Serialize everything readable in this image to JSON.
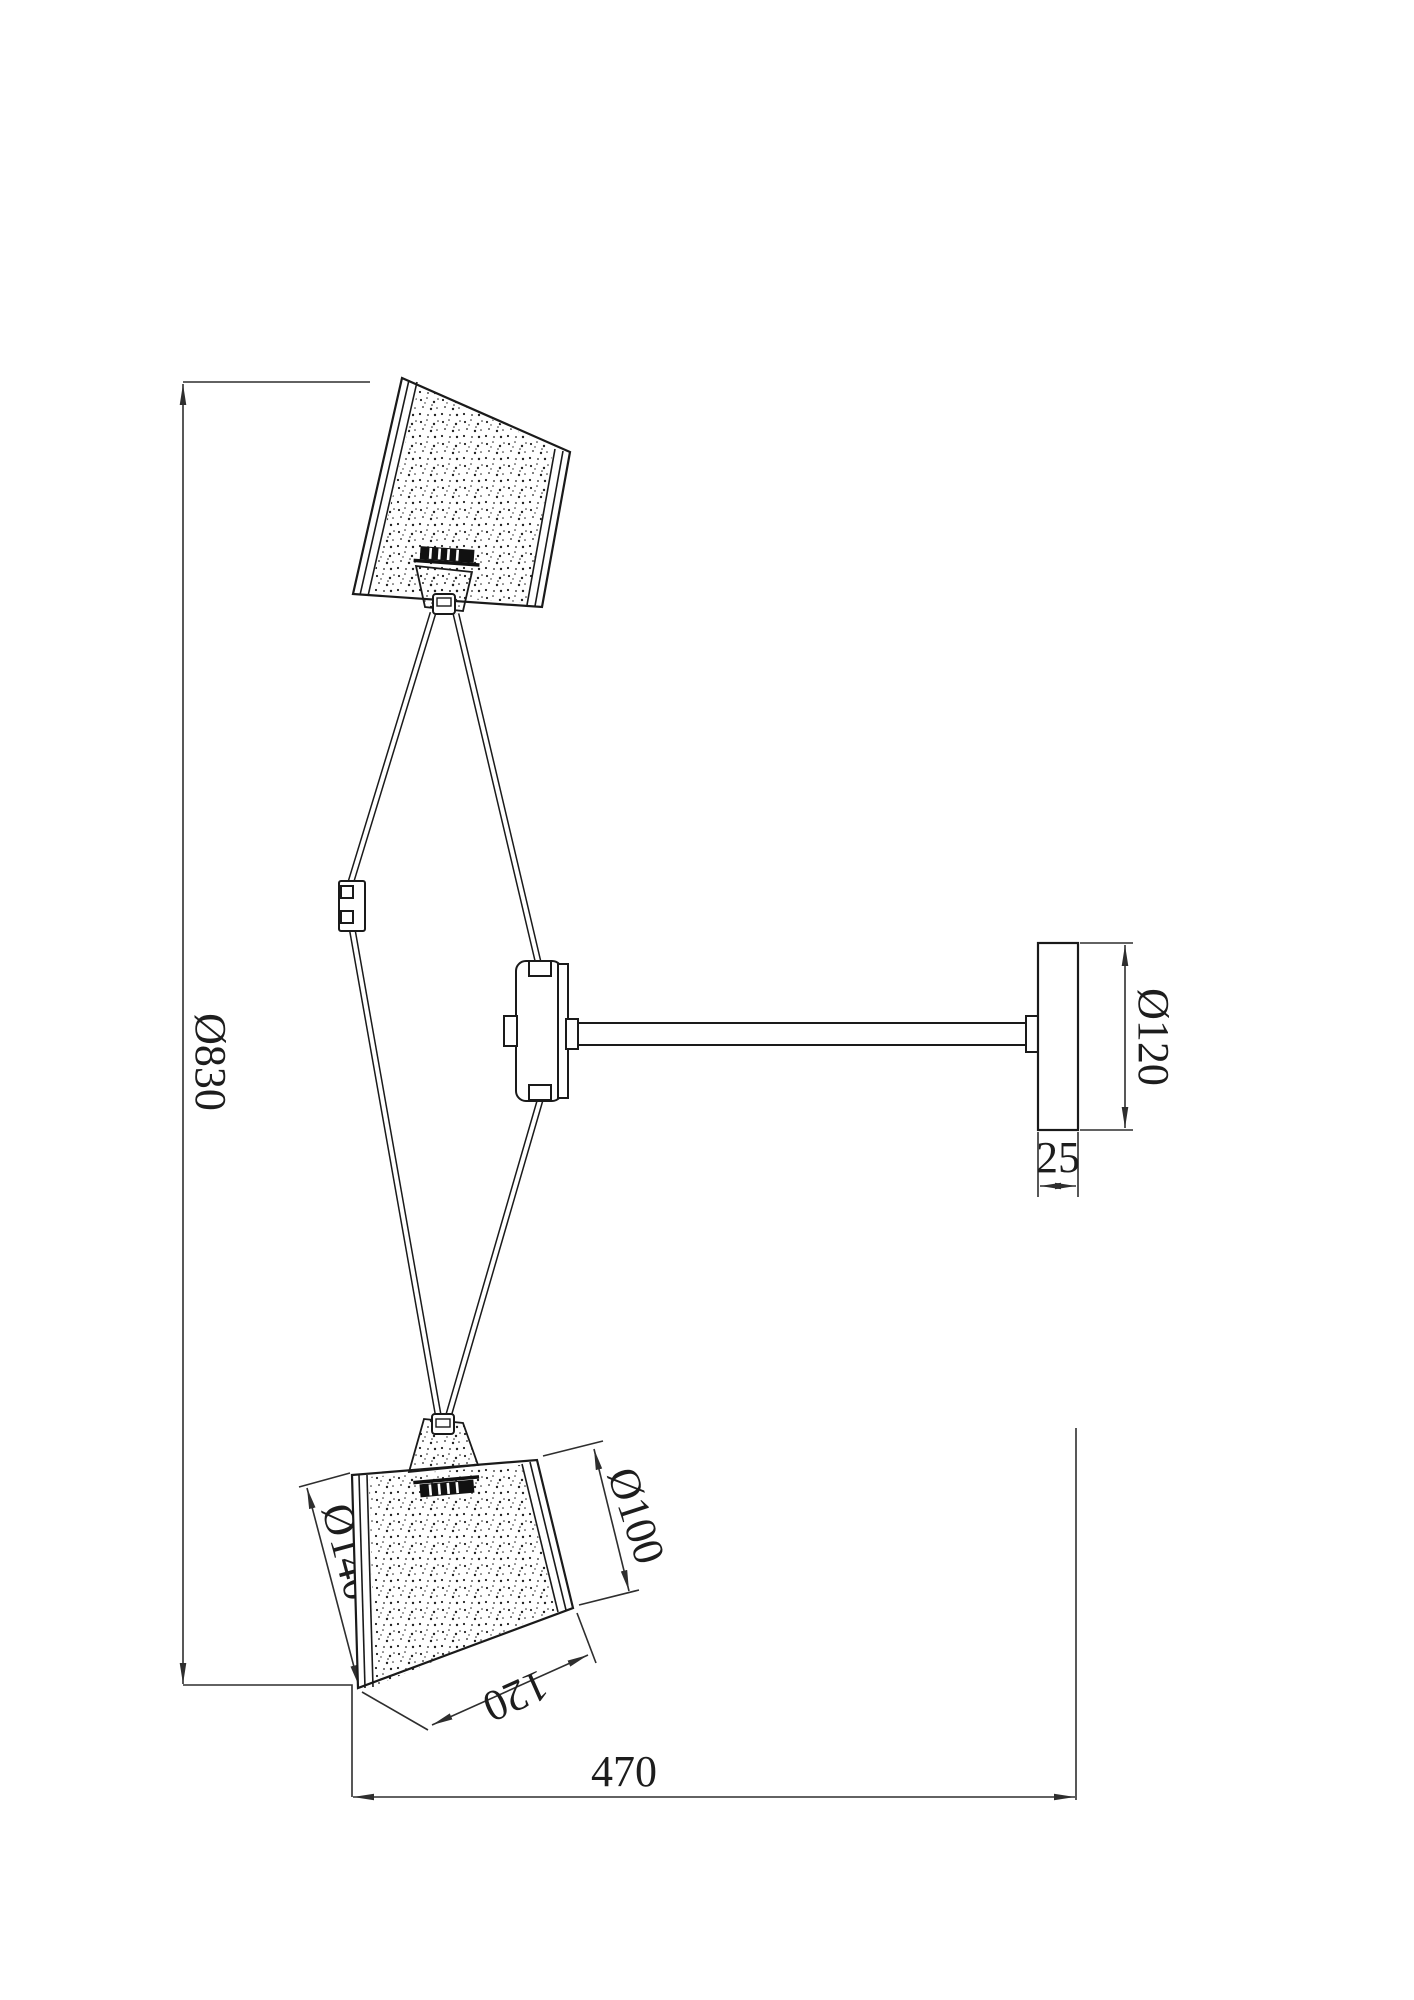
{
  "drawing": {
    "labels": {
      "overall_height": "Ø830",
      "projection": "470",
      "canopy_diameter": "Ø120",
      "canopy_depth": "25",
      "shade_large_diameter": "Ø140",
      "shade_small_diameter": "Ø100",
      "shade_height": "120"
    },
    "colors": {
      "part_line": "#1a1a1a",
      "dimension_line": "#2e2e2e",
      "background": "#ffffff"
    }
  }
}
